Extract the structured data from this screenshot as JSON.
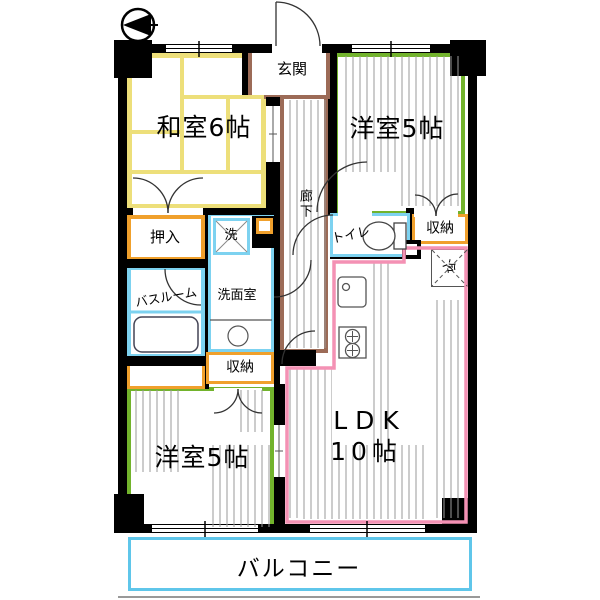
{
  "title": "apartment-floor-plan",
  "compass": {
    "icon": "north-arrow",
    "direction": "left"
  },
  "rooms": {
    "washitsu": {
      "label": "和室6帖"
    },
    "yoshitsu_tr": {
      "label": "洋室5帖"
    },
    "yoshitsu_bl": {
      "label": "洋室5帖"
    },
    "ldk": {
      "label": "LDK",
      "size": "１0帖",
      "size_label": "10帖"
    },
    "genkan": {
      "label": "玄関"
    },
    "rouka": {
      "label": "廊下"
    },
    "oshiire": {
      "label": "押入"
    },
    "bathroom": {
      "label": "バスルーム"
    },
    "senmenshitsu": {
      "label": "洗面室"
    },
    "toilet": {
      "label": "トイレ"
    },
    "shuunou_tr": {
      "label": "収納"
    },
    "shuunou_bc": {
      "label": "収納"
    },
    "washer": {
      "label": "洗"
    },
    "fridge": {
      "label": "冷"
    },
    "balcony": {
      "label": "バルコニー"
    }
  },
  "colors": {
    "wall": "#000000",
    "tatami_yellow": "#EDDF7A",
    "western_green": "#72B32C",
    "entry_brown": "#9C6B57",
    "wet_blue": "#7DD2F0",
    "closet_orange": "#F0A02C",
    "ldk_pink": "#F491B4",
    "balcony_blue": "#5FC6EA",
    "hatch_gray": "#9A9A9A"
  }
}
